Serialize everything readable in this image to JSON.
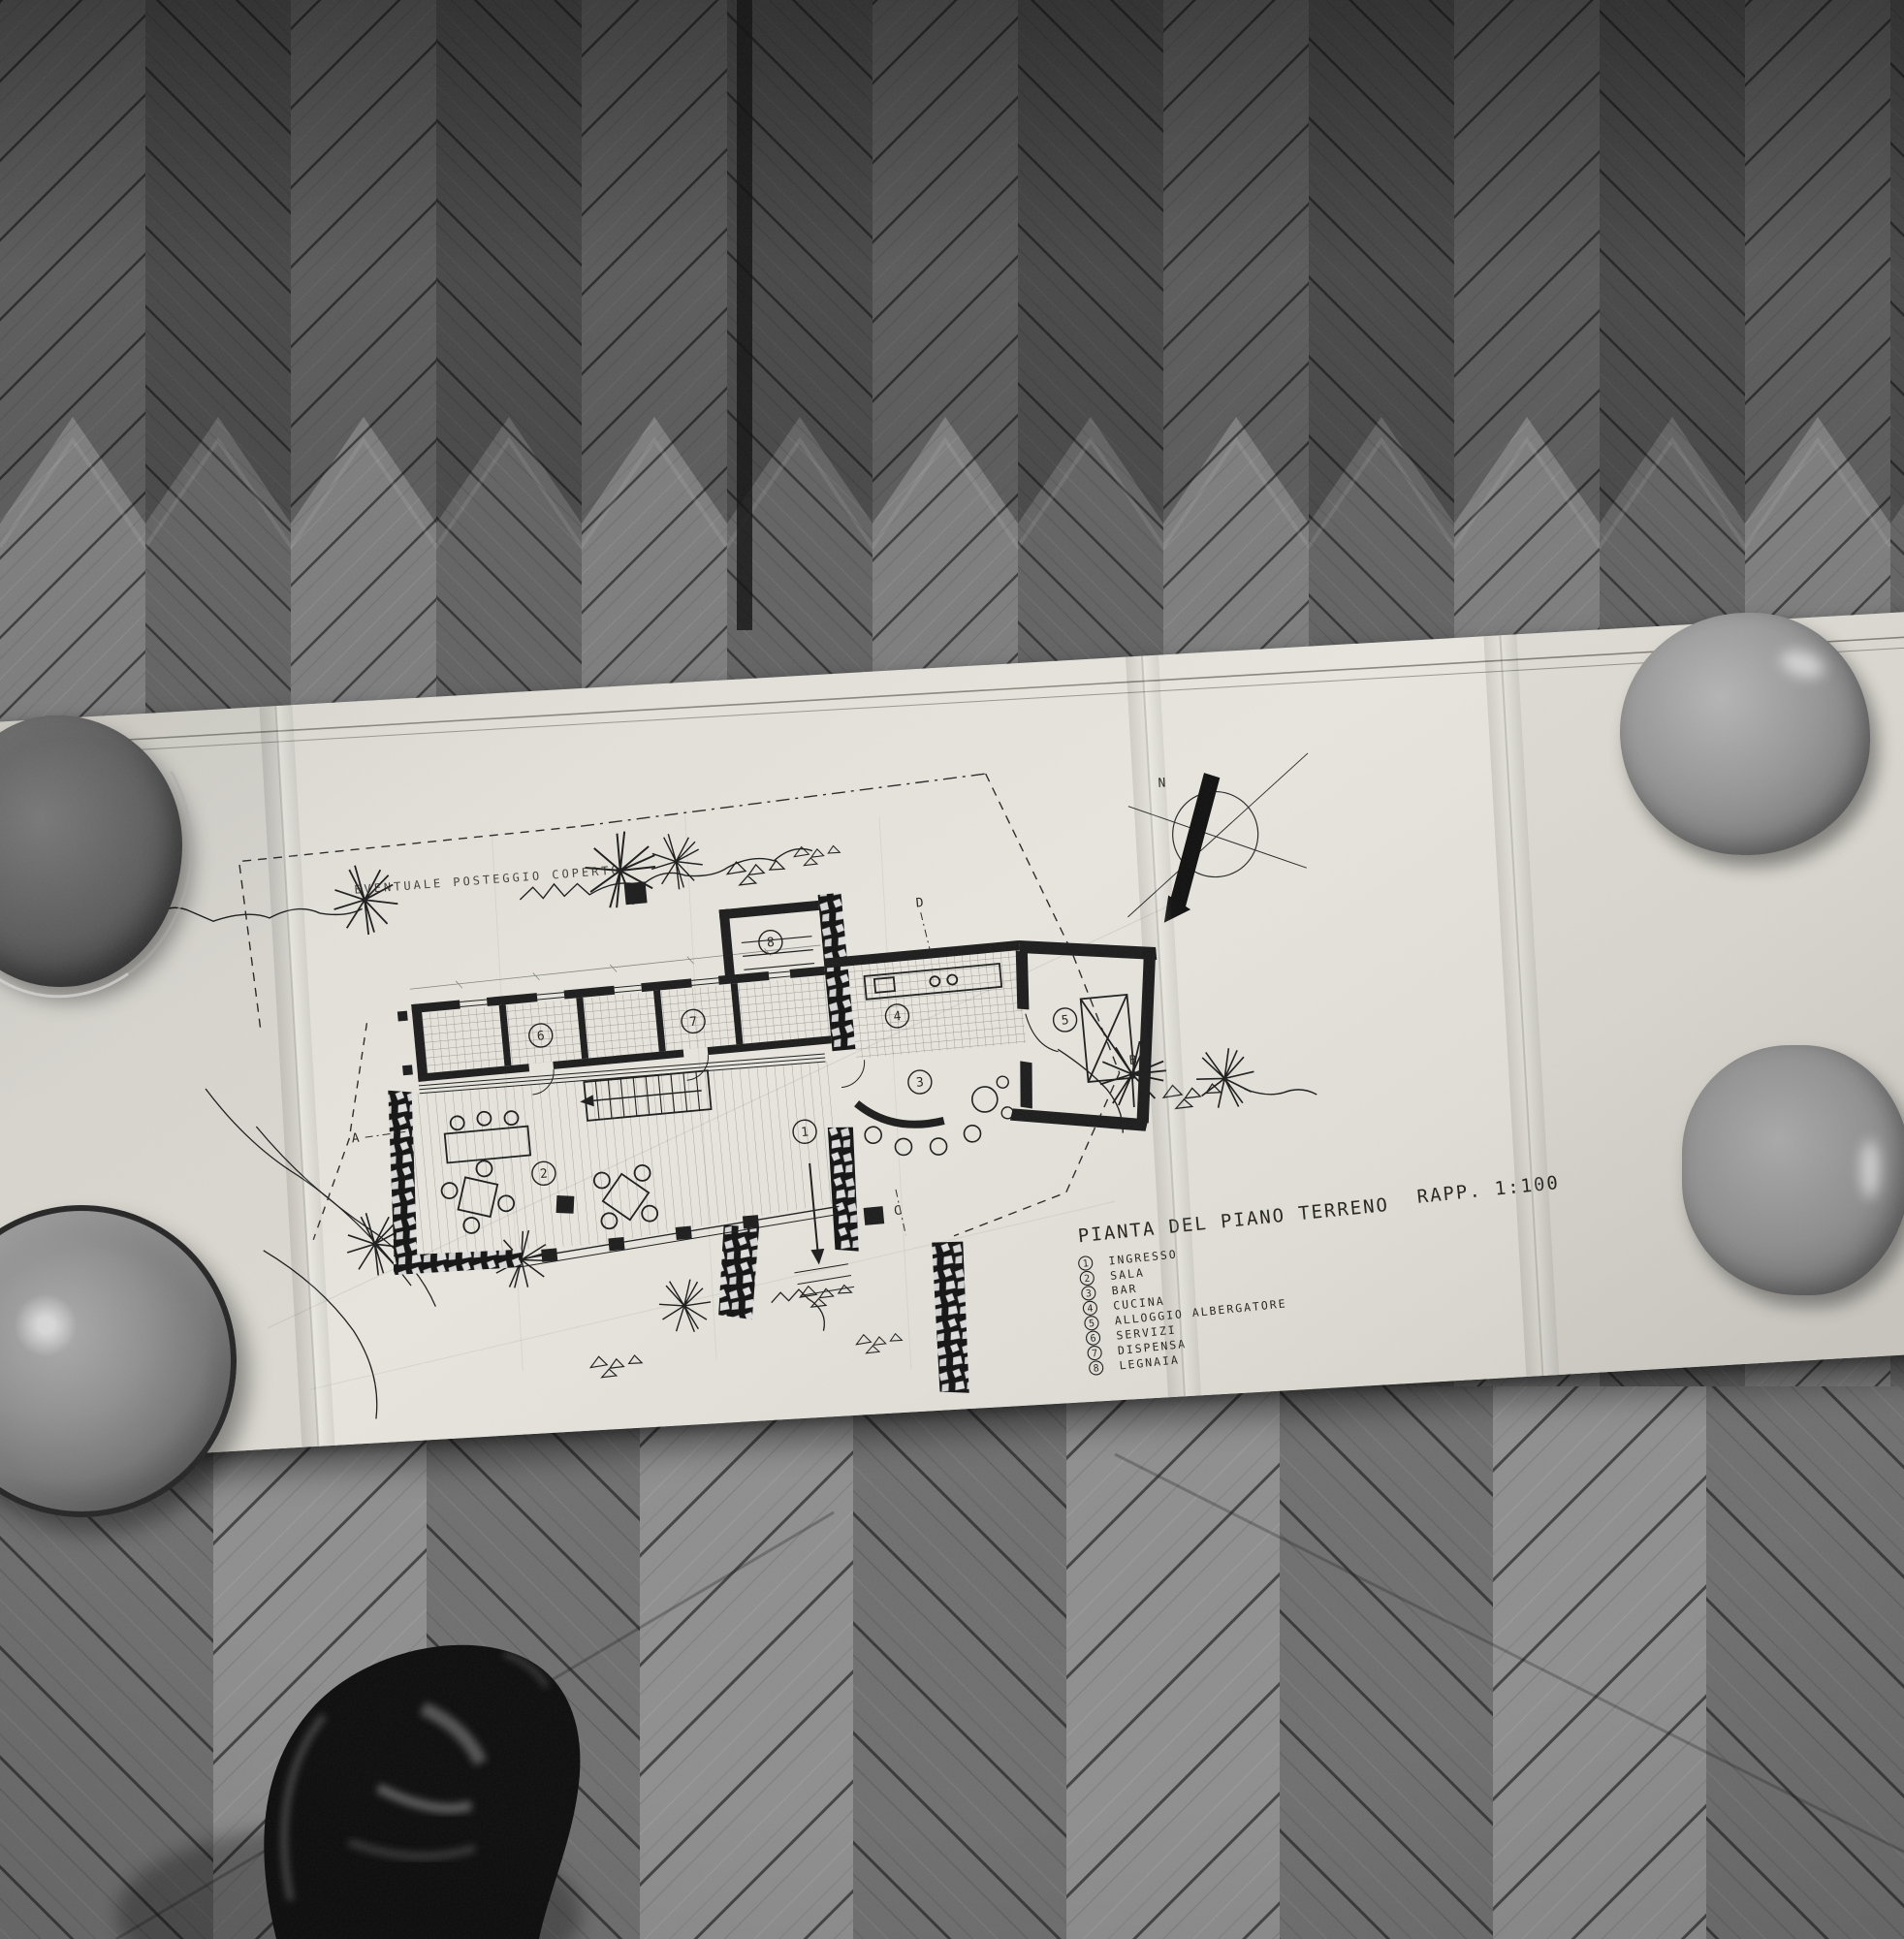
{
  "drawing": {
    "title": "PIANTA DEL PIANO TERRENO",
    "scale_label": "RAPP. 1:100",
    "site_note": "EVENTUALE POSTEGGIO COPERTO",
    "compass_label": "N",
    "section_markers": [
      "A",
      "B",
      "C",
      "D"
    ],
    "rooms": [
      {
        "n": "1",
        "label": "INGRESSO"
      },
      {
        "n": "2",
        "label": "SALA"
      },
      {
        "n": "3",
        "label": "BAR"
      },
      {
        "n": "4",
        "label": "CUCINA"
      },
      {
        "n": "5",
        "label": "ALLOGGIO ALBERGATORE"
      },
      {
        "n": "6",
        "label": "SERVIZI"
      },
      {
        "n": "7",
        "label": "DISPENSA"
      },
      {
        "n": "8",
        "label": "LEGNAIA"
      }
    ],
    "colors": {
      "paper": "#e4e2da",
      "ink": "#1f1f1f"
    }
  },
  "scene": {
    "colors": {
      "floor_dark": "#4f4f4f",
      "floor_light": "#828282",
      "shoe": "#0d0d0d"
    }
  }
}
